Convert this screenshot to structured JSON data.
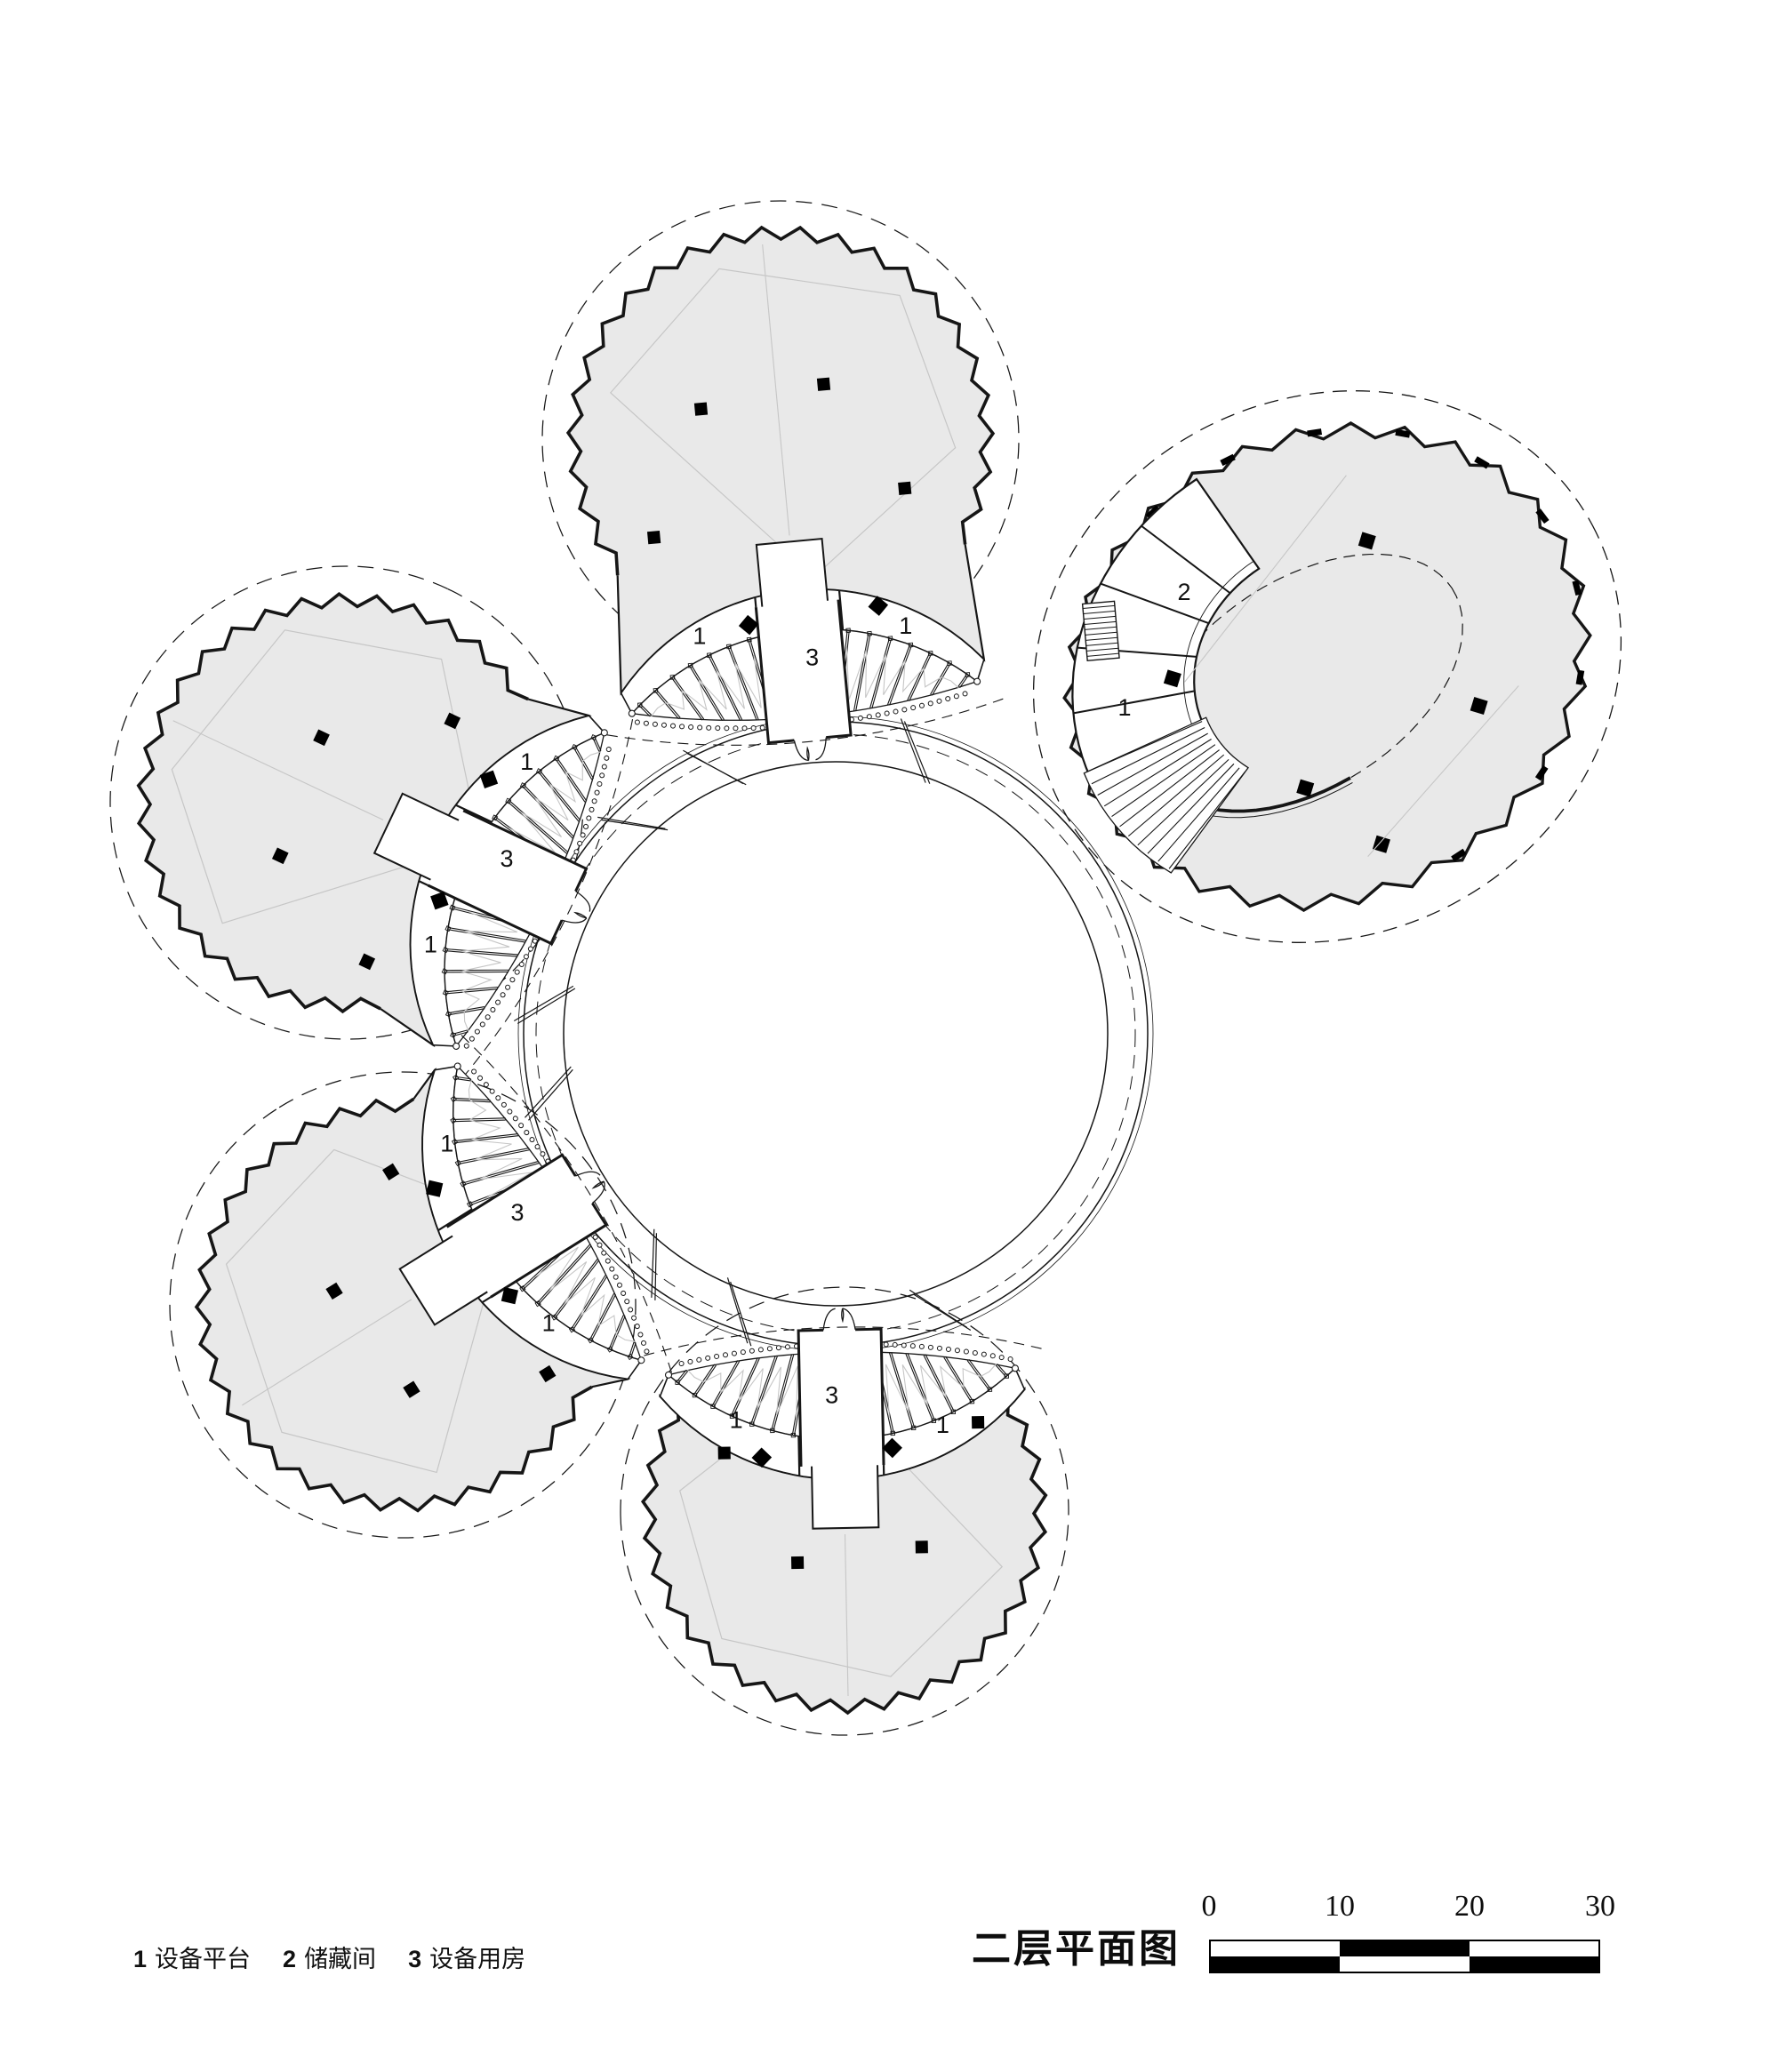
{
  "title": {
    "text": "二层平面图"
  },
  "legend": {
    "items": [
      {
        "num": "1",
        "label": "设备平台"
      },
      {
        "num": "2",
        "label": "储藏间"
      },
      {
        "num": "3",
        "label": "设备用房"
      }
    ]
  },
  "scale_bar": {
    "ticks": [
      "0",
      "10",
      "20",
      "30"
    ]
  },
  "plan": {
    "pavilions": [
      {
        "id": "north",
        "labels": [
          "1",
          "3",
          "1"
        ]
      },
      {
        "id": "west",
        "labels": [
          "1",
          "3",
          "1"
        ]
      },
      {
        "id": "southwest",
        "labels": [
          "1",
          "3",
          "1"
        ]
      },
      {
        "id": "south",
        "labels": [
          "1",
          "3",
          "1"
        ]
      },
      {
        "id": "northeast",
        "labels": [
          "2",
          "1"
        ]
      }
    ]
  },
  "colors": {
    "roof_fill": "#e9e9e9",
    "line": "#161616",
    "faint": "#c6c6c6"
  }
}
